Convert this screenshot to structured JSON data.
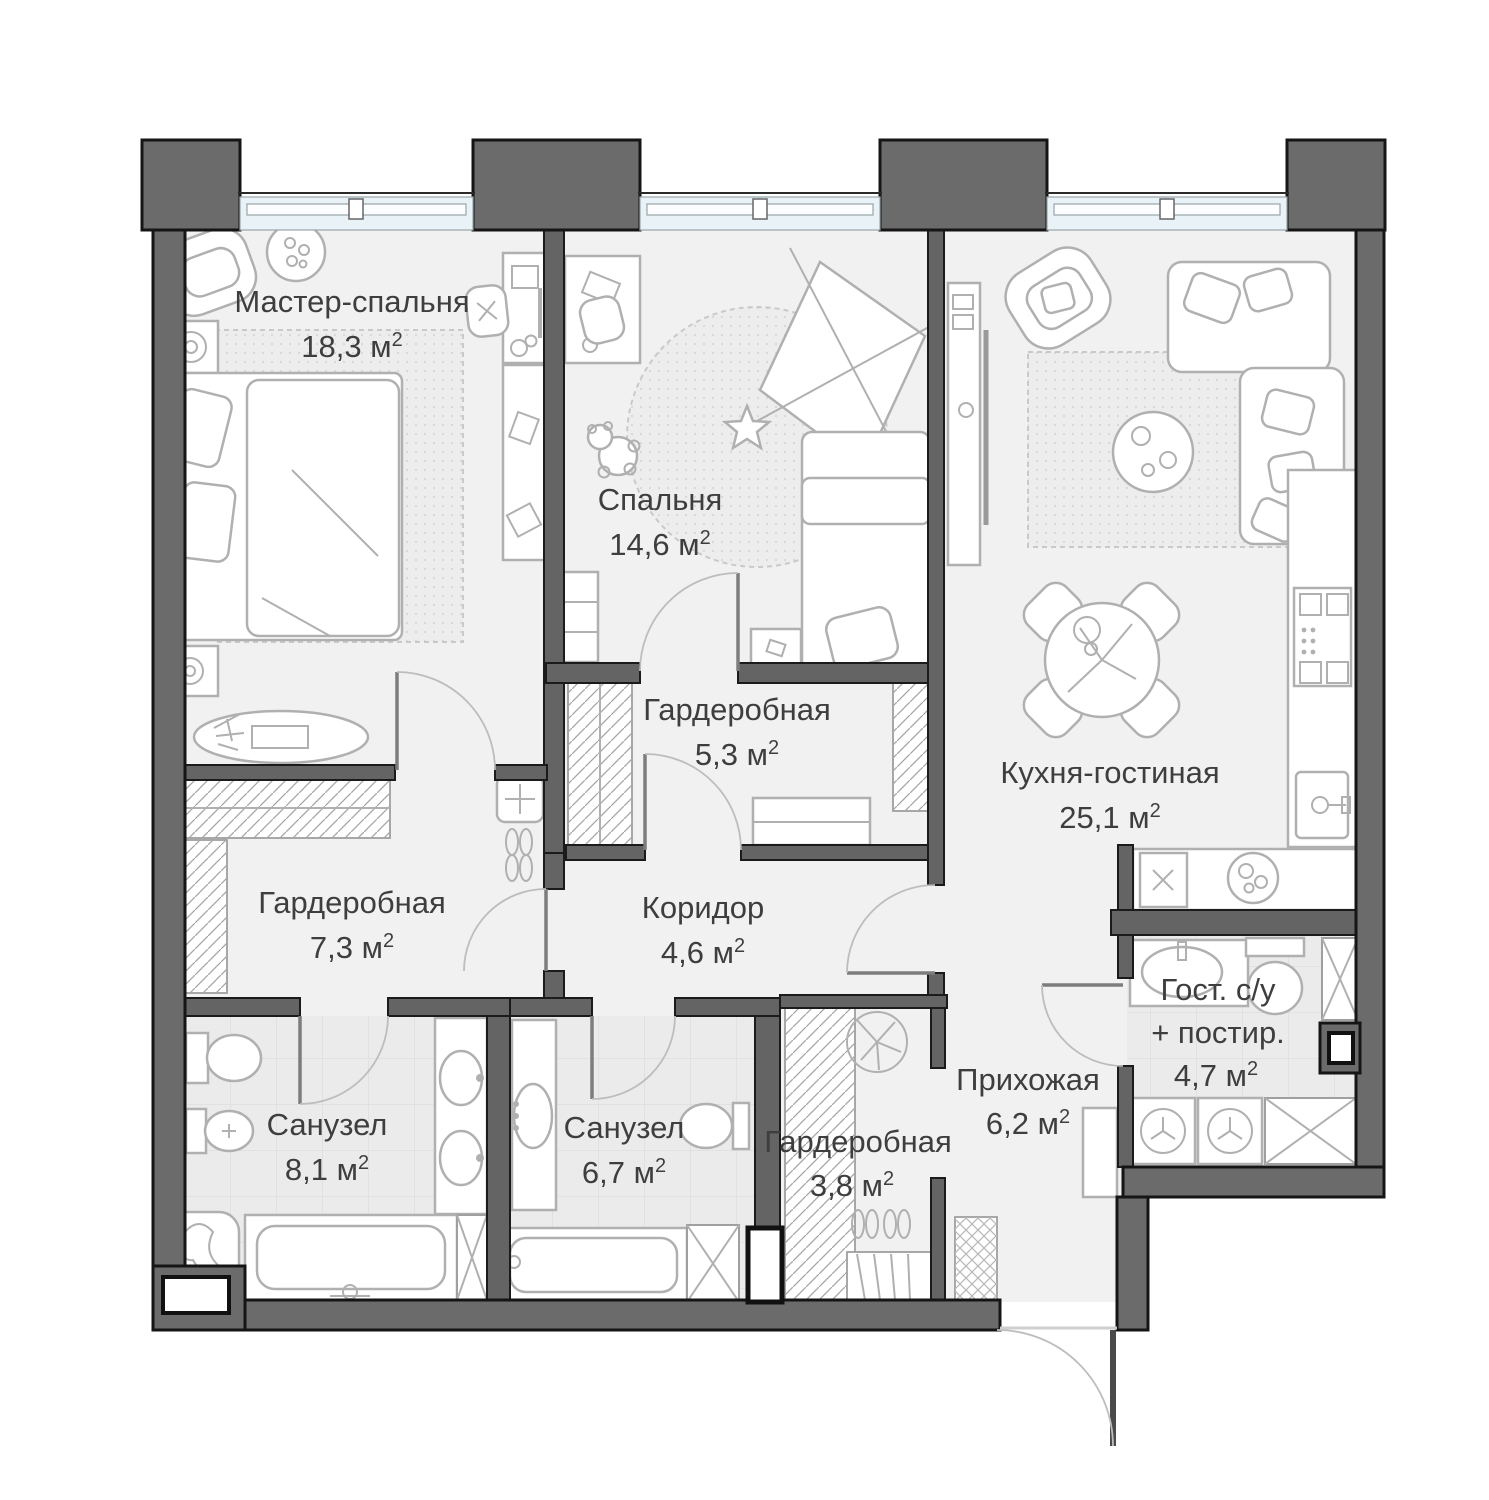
{
  "plan": {
    "type": "apartment-floor-plan",
    "language": "ru",
    "rooms": [
      {
        "id": "master-bedroom",
        "name": "Мастер-спальня",
        "area": "18,3",
        "area_label": "18,3 м",
        "sup": "2"
      },
      {
        "id": "bedroom",
        "name": "Спальня",
        "area": "14,6",
        "area_label": "14,6 м",
        "sup": "2"
      },
      {
        "id": "wardrobe-5-3",
        "name": "Гардеробная",
        "area": "5,3",
        "area_label": "5,3 м",
        "sup": "2"
      },
      {
        "id": "kitchen-living",
        "name": "Кухня-гостиная",
        "area": "25,1",
        "area_label": "25,1 м",
        "sup": "2"
      },
      {
        "id": "wardrobe-7-3",
        "name": "Гардеробная",
        "area": "7,3",
        "area_label": "7,3 м",
        "sup": "2"
      },
      {
        "id": "corridor",
        "name": "Коридор",
        "area": "4,6",
        "area_label": "4,6 м",
        "sup": "2"
      },
      {
        "id": "bathroom-1",
        "name": "Санузел",
        "area": "8,1",
        "area_label": "8,1 м",
        "sup": "2"
      },
      {
        "id": "bathroom-2",
        "name": "Санузел",
        "area": "6,7",
        "area_label": "6,7 м",
        "sup": "2"
      },
      {
        "id": "wardrobe-3-8",
        "name": "Гардеробная",
        "area": "3,8",
        "area_label": "3,8 м",
        "sup": "2"
      },
      {
        "id": "hallway",
        "name": "Прихожая",
        "area": "6,2",
        "area_label": "6,2 м",
        "sup": "2"
      },
      {
        "id": "guest-wc",
        "name": "Гост. с/у",
        "name2": "+ постир.",
        "area": "4,7",
        "area_label": "4,7 м",
        "sup": "2"
      }
    ],
    "colors": {
      "exterior_wall": "#6b6b6b",
      "interior_wall": "#646464",
      "outline": "#151515",
      "floor": "#f1f1f1",
      "bathroom_tile": "#ebebeb",
      "window_glass": "#e8f2f7",
      "furniture_stroke": "#b0b0b0",
      "label_text": "#3e3e3e"
    }
  }
}
